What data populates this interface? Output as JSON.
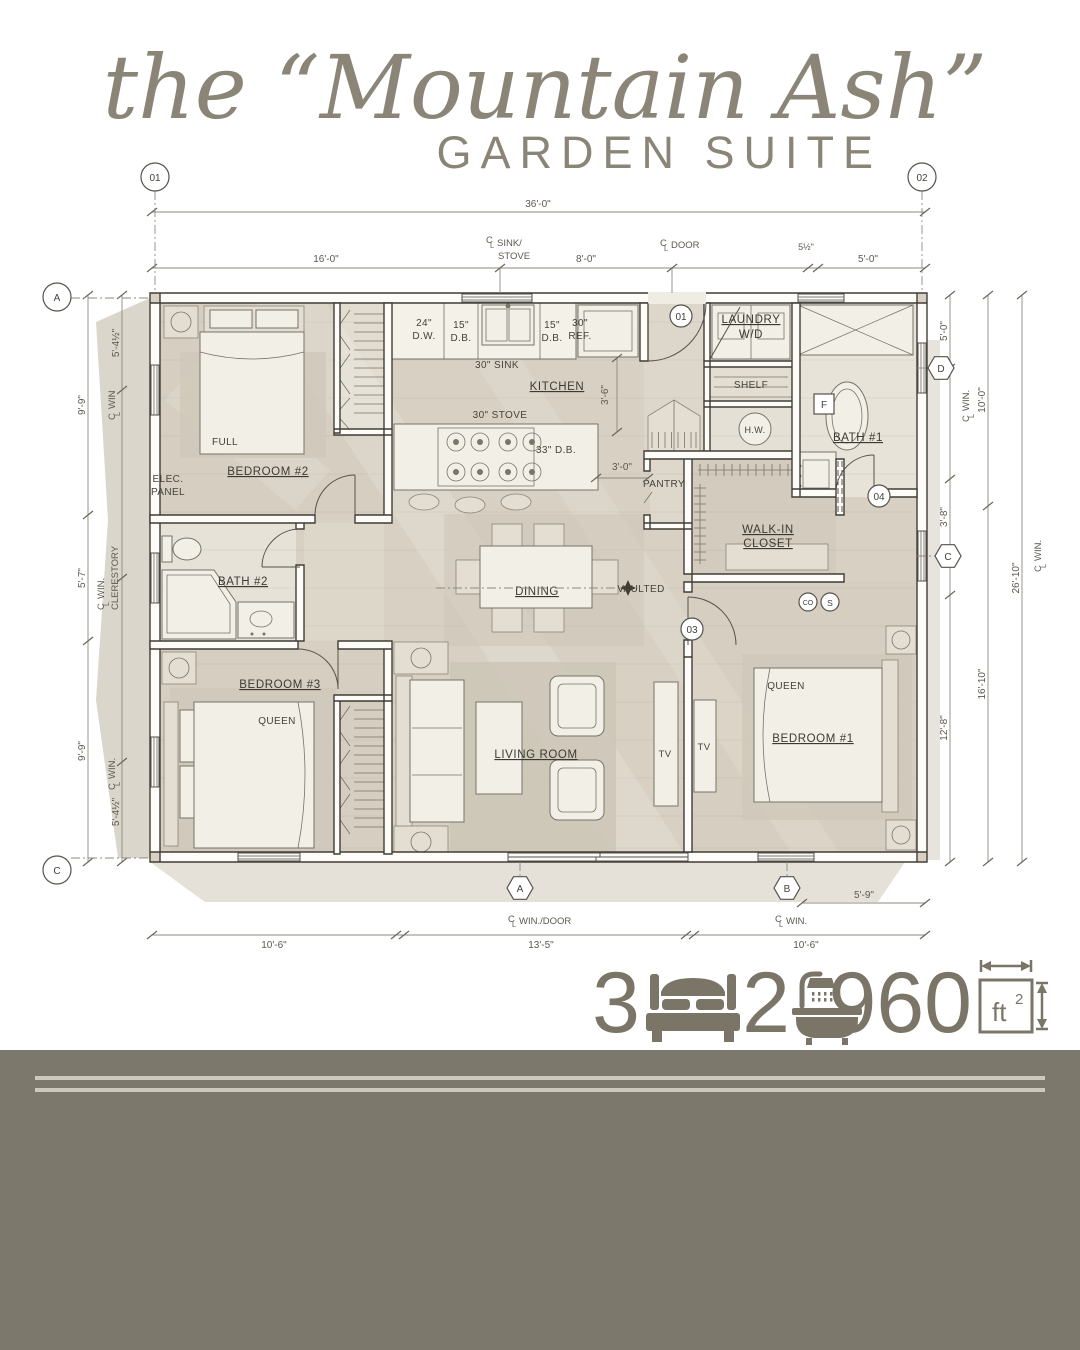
{
  "title": {
    "script": "the “Mountain Ash”",
    "subtitle": "GARDEN SUITE"
  },
  "stats": {
    "beds": "3",
    "baths": "2",
    "area": "960",
    "unit": "ft",
    "sup": "2"
  },
  "rooms": {
    "bedroom1": "BEDROOM #1",
    "bedroom2": "BEDROOM #2",
    "bedroom3": "BEDROOM #3",
    "bath1": "BATH #1",
    "bath2": "BATH #2",
    "kitchen": "KITCHEN",
    "dining": "DINING",
    "living": "LIVING ROOM",
    "laundry": "LAUNDRY",
    "wd": "W/D",
    "shelf": "SHELF",
    "pantry": "PANTRY",
    "walkin1": "WALK-IN",
    "walkin2": "CLOSET",
    "hw": "H.W.",
    "vaulted": "VAULTED",
    "elec1": "ELEC.",
    "elec2": "PANEL",
    "full": "FULL",
    "queen": "QUEEN",
    "tv": "TV"
  },
  "kitchen": {
    "dw1": "24\"",
    "dw2": "D.W.",
    "db1": "15\"",
    "db2": "D.B.",
    "sink": "30\" SINK",
    "ref1": "30\"",
    "ref2": "REF.",
    "stove": "30\" STOVE",
    "db33": "33\" D.B."
  },
  "dims": {
    "overall": "36'-0\"",
    "top": [
      "16'-0\"",
      "8'-0\"",
      "5½\"",
      "5'-0\""
    ],
    "left_outer": [
      "9'-9\"",
      "5'-7\"",
      "9'-9\""
    ],
    "left_inner": [
      "5'-4½\"",
      "5'-4½\""
    ],
    "right": [
      "5'-0\"",
      "10'-0\"",
      "3'-8\"",
      "26'-10\"",
      "16'-10\"",
      "12'-8\""
    ],
    "bottom": [
      "10'-6\"",
      "13'-5\"",
      "10'-6\"",
      "5'-9\""
    ],
    "interior": [
      "3'-6\"",
      "3'-0\""
    ]
  },
  "cl": {
    "c": "C",
    "l": "L",
    "win": "WIN.",
    "win_plain": "WIN",
    "door": "DOOR",
    "sink": "SINK/",
    "stove": "STOVE",
    "clerestory": "CLERESTORY",
    "windoor": "WIN./DOOR"
  },
  "markers": {
    "grid01": "01",
    "grid02": "02",
    "gridA": "A",
    "gridC": "C",
    "hexA": "A",
    "hexB": "B",
    "hexC": "C",
    "hexD": "D",
    "door01": "01",
    "door03": "03",
    "door04": "04",
    "fan": "F",
    "co": "CO",
    "smoke": "S"
  },
  "colors": {
    "accent": "#7b7568",
    "band": "#7c786c",
    "floor": "#d8d1c3",
    "line": "#403d36"
  }
}
